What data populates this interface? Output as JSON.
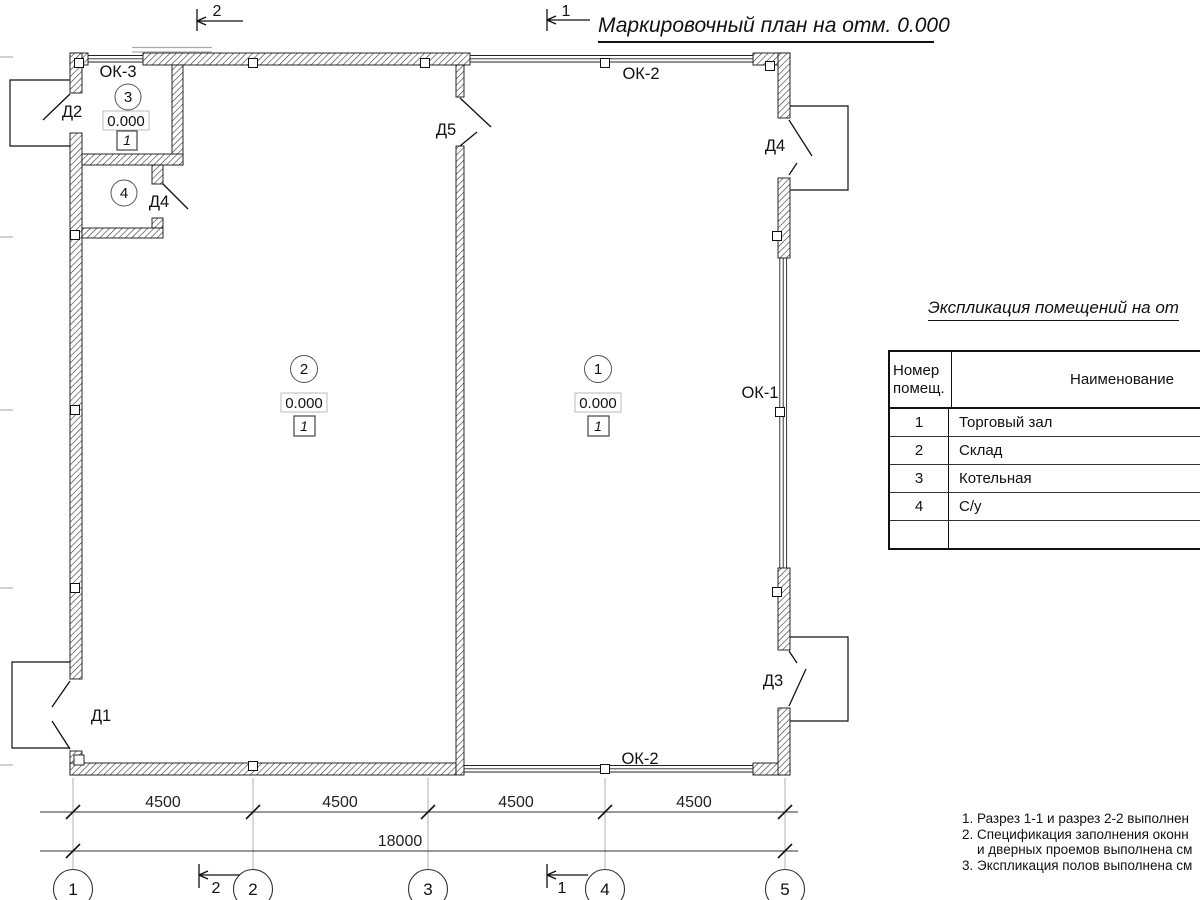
{
  "title": "Маркировочный план на отм. 0.000",
  "sections": {
    "top2": "2",
    "top1": "1",
    "bottom2": "2",
    "bottom1": "1"
  },
  "openings": {
    "ok3": "ОК-3",
    "ok2_top": "ОК-2",
    "ok2_bottom": "ОК-2",
    "ok1": "ОК-1",
    "d1": "Д1",
    "d2": "Д2",
    "d3": "Д3",
    "d4_right": "Д4",
    "d4_inner": "Д4",
    "d5": "Д5"
  },
  "rooms": [
    {
      "number": "1",
      "elevation": "0.000",
      "floor": "1"
    },
    {
      "number": "2",
      "elevation": "0.000",
      "floor": "1"
    },
    {
      "number": "3",
      "elevation": "0.000",
      "floor": "1"
    },
    {
      "number": "4",
      "elevation": "",
      "floor": ""
    }
  ],
  "dims": {
    "s1": "4500",
    "s2": "4500",
    "s3": "4500",
    "s4": "4500",
    "total": "18000"
  },
  "axes": {
    "a1": "1",
    "a2": "2",
    "a3": "3",
    "a4": "4",
    "a5": "5"
  },
  "table": {
    "title": "Экспликация помещений на от",
    "header": {
      "col1a": "Номер",
      "col1b": "помещ.",
      "col2": "Наименование"
    },
    "rows": [
      {
        "num": "1",
        "name": "Торговый зал"
      },
      {
        "num": "2",
        "name": "Склад"
      },
      {
        "num": "3",
        "name": "Котельная"
      },
      {
        "num": "4",
        "name": "С/у"
      },
      {
        "num": "",
        "name": ""
      }
    ]
  },
  "notes": {
    "l1": "1. Разрез 1-1 и разрез 2-2 выполнен",
    "l2": "2. Спецификация заполнения оконн",
    "l3": "и дверных проемов выполнена см",
    "l4": "3. Экспликация полов выполнена см"
  }
}
